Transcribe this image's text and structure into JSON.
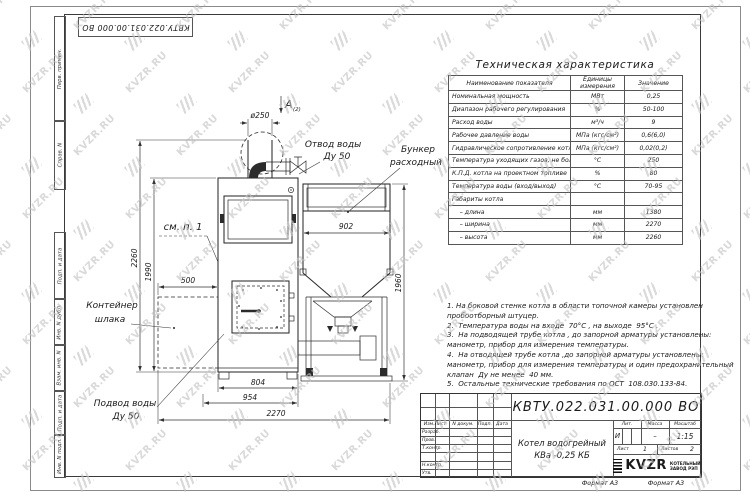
{
  "watermark": {
    "text": "KVZR.RU",
    "color": "#c3c3c3"
  },
  "corner_stamp": {
    "designation": "КВТУ.022.031.00.000  ВО"
  },
  "side_strip": {
    "cells": [
      "Перв. примен.",
      "Справ. N",
      "Подп. и дата",
      "Инв. N дубл.",
      "Взам. инв. N",
      "Подп. и дата",
      "Инв. N подл."
    ]
  },
  "drawing": {
    "view_letter": "А",
    "view_sheet_ref": "(2)",
    "dims": {
      "d250": "ø250",
      "h2260": "2260",
      "h1990": "1990",
      "w500": "500",
      "w902": "902",
      "h1960": "1960",
      "w804": "804",
      "w954": "954",
      "w2270": "2270"
    },
    "labels": {
      "outlet1": "Отвод воды",
      "outlet2": "Ду 50",
      "bunker1": "Бункер",
      "bunker2": "расходный",
      "see_note": "см. п. 1",
      "slag1": "Контейнер",
      "slag2": "шлака",
      "inlet1": "Подвод воды",
      "inlet2": "Ду 50"
    }
  },
  "spec_table": {
    "title": "Техническая характеристика",
    "headers": [
      "Наименование показателя",
      "Единицы\nизмерения",
      "Значение"
    ],
    "rows": [
      [
        "Номинальная мощность",
        "МВт",
        "0,25"
      ],
      [
        "Диапазон рабочего регулирования",
        "%",
        "50-100"
      ],
      [
        "Расход воды",
        "м³/ч",
        "9"
      ],
      [
        "Рабочее давление воды",
        "МПа (кгс/см²)",
        "0,6(6,0)"
      ],
      [
        "Гидравлическое сопротивление котла",
        "МПа (кгс/см²)",
        "0,02(0,2)"
      ],
      [
        "Температура уходящих газов, не более",
        "°С",
        "250"
      ],
      [
        "К.П.Д. котла на проектном топливе",
        "%",
        "80"
      ],
      [
        "Температура воды (вход/выход)",
        "°С",
        "70-95"
      ],
      [
        "Габариты котла",
        "",
        ""
      ],
      [
        "    – длина",
        "мм",
        "1380"
      ],
      [
        "    – ширина",
        "мм",
        "2270"
      ],
      [
        "    – высота",
        "мм",
        "2260"
      ]
    ]
  },
  "notes": {
    "lines": [
      "1. На боковой стенке котла в области топочной камеры установлен",
      "пробоотборный штуцер.",
      "2.  Температура воды на входе  70°С , на выходе  95°С .",
      "3.  На подводящей трубе котла , до запорной арматуры установлены:",
      "манометр, прибор для измерения температуры.",
      "4.  На отводящей трубе котла ,до запорной арматуры установлены:",
      "манометр, прибор для измерения температуры и один предохранительный",
      "клапан  Ду не менее  40 мм.",
      "5.  Остальные технические требования по ОСТ  108.030.133-84."
    ]
  },
  "title_block": {
    "designation": "КВТУ.022.031.00.000  ВО",
    "name_line1": "Котел водогрейный",
    "name_line2": "КВа -0,25  КБ",
    "header_cols": [
      "Изм.Лист",
      "N докум.",
      "Подп.",
      "Дата"
    ],
    "staff_rows": [
      "Разраб.",
      "Пров.",
      "Т.контр.",
      "",
      "Н.контр.",
      "Утв."
    ],
    "lit_label": "Лит.",
    "mass_label": "Масса",
    "scale_label": "Масштаб",
    "lit": "И",
    "mass": "–",
    "scale": "1:15",
    "sheet_label": "Лист",
    "sheet_num": "1",
    "sheets_label": "Листов",
    "sheets_num": "2",
    "logo": "KVZR",
    "logo_line1": "КОТЕЛЬНЫЙ",
    "logo_line2": "ЗАВОД РЭП",
    "format": "Формат А3"
  }
}
